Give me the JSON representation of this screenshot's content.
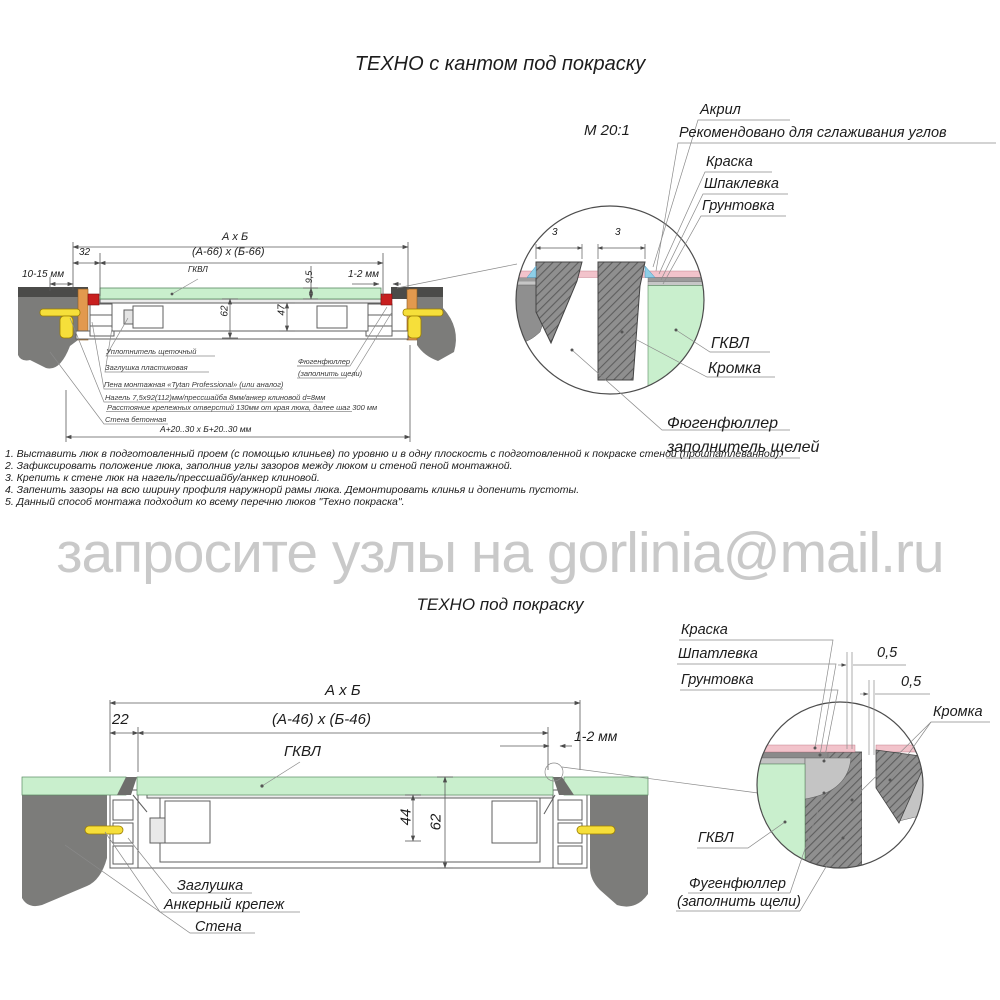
{
  "top_section": {
    "title": "ТЕХНО с кантом под покраску",
    "scale_label": "М 20:1",
    "detail_labels": {
      "akril": "Акрил",
      "recommend": "Рекомендовано для сглаживания углов",
      "kraska": "Краска",
      "shpaklevka": "Шпаклевка",
      "gruntovka": "Грунтовка",
      "gkvl": "ГКВЛ",
      "kromka": "Кромка",
      "fugen_line1": "Фюгенфюллер",
      "fugen_line2": "заполнитель щелей",
      "dim3_left": "3",
      "dim3_right": "3"
    },
    "dims": {
      "axb": "А х Б",
      "inner": "(А-66) х (Б-66)",
      "d32": "32",
      "d10_15": "10-15 мм",
      "gkvl": "ГКВЛ",
      "d9_5": "9,5",
      "d1_2": "1-2 мм",
      "d62": "62",
      "d47": "47",
      "bottom": "А+20..30 х Б+20..30 мм"
    },
    "annotations": [
      "Уплотнитель щеточный",
      "Заглушка пластиковая",
      "Пена монтажная «Tytan Professional» (или аналог)",
      "Нагель 7,5х92(112)мм/прессшайба 8мм/анкер клиновой d=8мм",
      "Расстояние крепежных отверстий 130мм от края люка, далее шаг 300 мм",
      "Стена бетонная"
    ],
    "fugen_note_line1": "Фюгенфюллер",
    "fugen_note_line2": "(заполнить щели)"
  },
  "notes": [
    "1. Выставить люк в подготовленный проем (с помощью клиньев) по уровню и в одну плоскость с подготовленной к покраске стеной (прошпатлеванной).",
    "2. Зафиксировать положение люка, заполнив углы зазоров между люком и стеной пеной монтажной.",
    "3. Крепить к стене люк на нагель/прессшайбу/анкер клиновой.",
    "4. Запенить зазоры на всю ширину профиля наружнорй рамы люка. Демонтировать клинья и допенить пустоты.",
    "5. Данный способ монтажа подходит ко всему перечню люков \"Техно покраска\"."
  ],
  "watermark": "запросите узлы на gorlinia@mail.ru",
  "bottom_section": {
    "title": "ТЕХНО под покраску",
    "dims": {
      "axb": "А х Б",
      "inner": "(А-46) х (Б-46)",
      "d22": "22",
      "gkvl": "ГКВЛ",
      "d1_2": "1-2 мм",
      "d44": "44",
      "d62": "62"
    },
    "detail_labels": {
      "kraska": "Краска",
      "shpatlevka": "Шпатлевка",
      "gruntovka": "Грунтовка",
      "d05a": "0,5",
      "d05b": "0,5",
      "kromka": "Кромка",
      "gkvl": "ГКВЛ",
      "fugen_line1": "Фугенфюллер",
      "fugen_line2": "(заполнить щели)"
    },
    "callouts": [
      "Заглушка",
      "Анкерный крепеж",
      "Стена"
    ]
  },
  "colors": {
    "gkvl_green": "#c9efcd",
    "paint_pink": "#f2c3cb",
    "wedge_orange": "#e2994e",
    "anchor_yellow": "#f6df3a",
    "seal_red": "#c81f1f",
    "wall_gray": "#7c7c7a",
    "beam_dark": "#4b4b49",
    "acrylic_blue": "#8ecfe8",
    "watermark_gray": "#c9c9c9"
  }
}
